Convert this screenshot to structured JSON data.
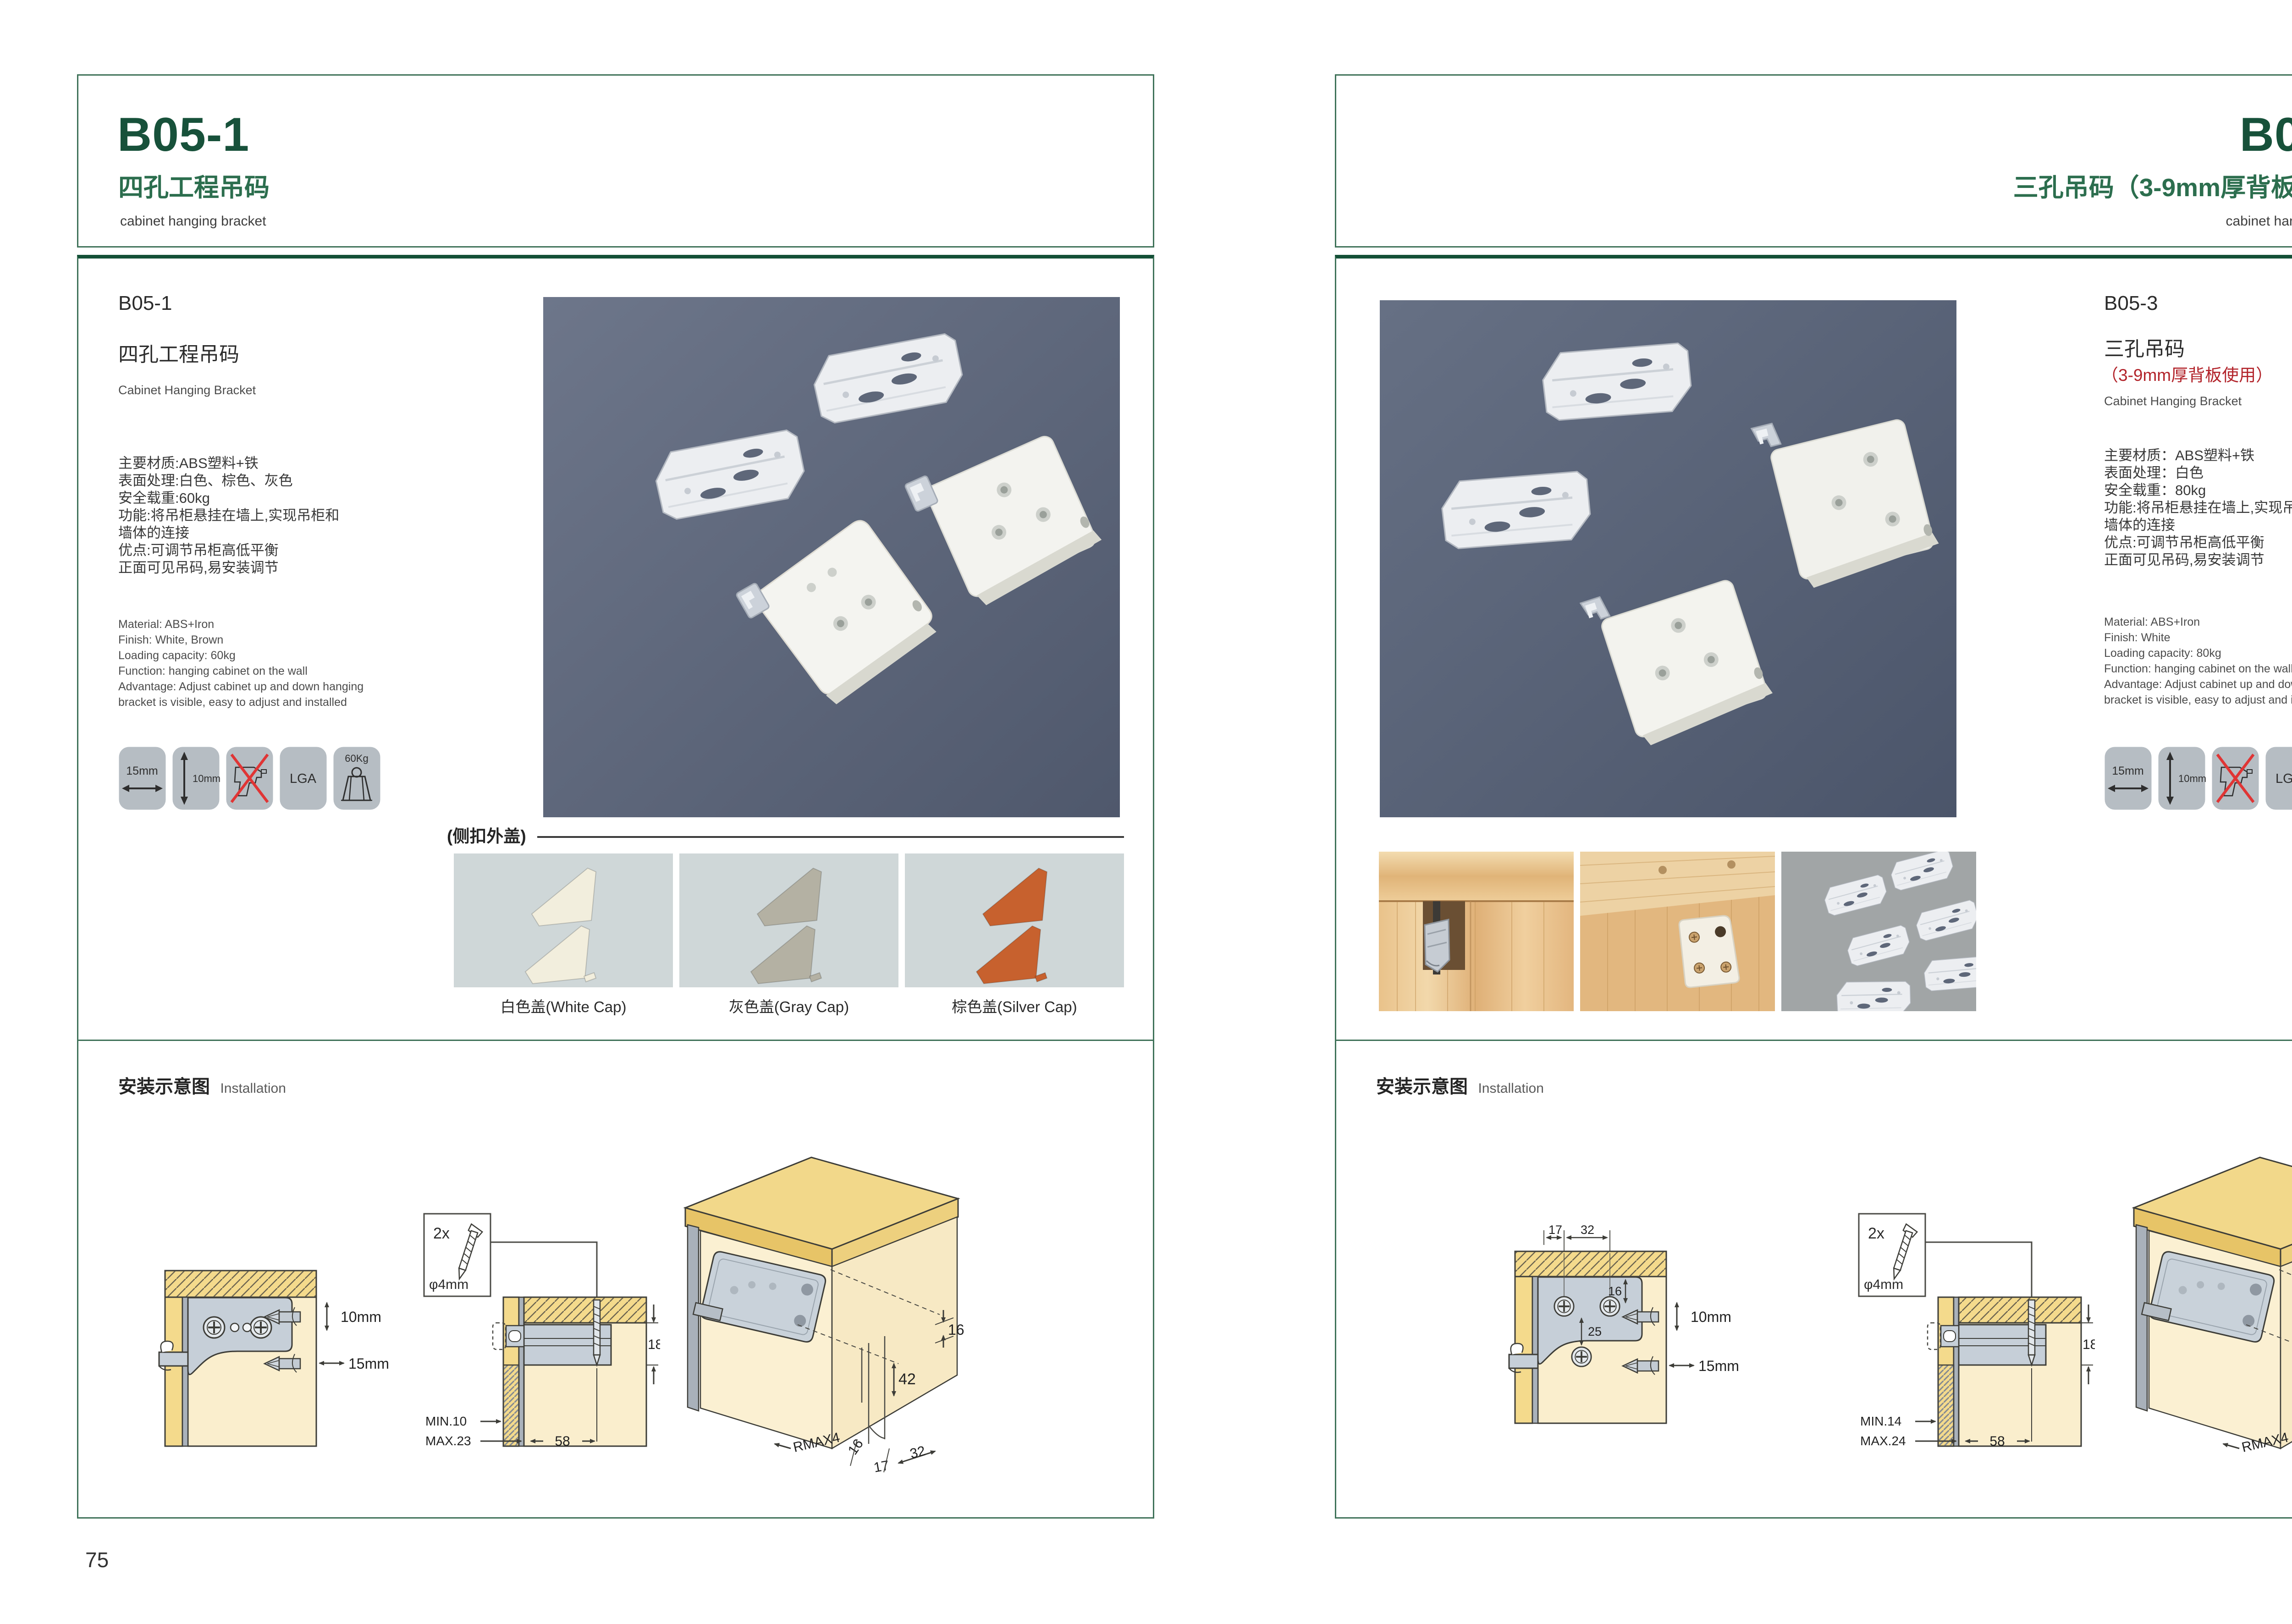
{
  "colors": {
    "brand_green": "#17513a",
    "mid_green": "#2c6e4e",
    "border_green": "#3f7259",
    "red": "#b2232a",
    "photo_bg_left": "#5a6477",
    "photo_bg_right": "#525c6f",
    "icon_bg": "#b6bdc3"
  },
  "left_page": {
    "header": {
      "code": "B05-1",
      "title_zh": "四孔工程吊码",
      "title_en": "cabinet hanging bracket"
    },
    "product": {
      "code": "B05-1",
      "name_zh": "四孔工程吊码",
      "name_en": "Cabinet Hanging Bracket",
      "specs_zh": [
        "主要材质:ABS塑料+铁",
        "表面处理:白色、棕色、灰色",
        "安全载重:60kg",
        "功能:将吊柜悬挂在墙上,实现吊柜和",
        "墙体的连接",
        "优点:可调节吊柜高低平衡",
        "正面可见吊码,易安装调节"
      ],
      "specs_en": [
        "Material: ABS+Iron",
        "Finish: White, Brown",
        "Loading capacity: 60kg",
        "Function: hanging cabinet on the wall",
        "Advantage: Adjust cabinet up and down hanging",
        "bracket is visible, easy to adjust and installed"
      ],
      "icons": {
        "width": "15mm",
        "height": "10mm",
        "cert": "LGA",
        "load": "60Kg"
      }
    },
    "caps": {
      "label": "(侧扣外盖)",
      "items": [
        {
          "caption": "白色盖(White Cap)",
          "color": "#f2eedd"
        },
        {
          "caption": "灰色盖(Gray Cap)",
          "color": "#b4b1a3"
        },
        {
          "caption": "棕色盖(Silver Cap)",
          "color": "#c7612e"
        }
      ]
    },
    "installation": {
      "title_zh": "安装示意图",
      "title_en": "Installation",
      "a": {
        "bit_v": "10mm",
        "bit_h": "15mm"
      },
      "b": {
        "qty": "2x",
        "dia": "φ4mm",
        "depth": "18",
        "min": "MIN.10",
        "max": "MAX.23",
        "width": "58"
      },
      "c": {
        "inset": "16",
        "height": "42",
        "radius": "RMAX4",
        "d16": "16",
        "d17": "17",
        "d32": "32"
      }
    },
    "page_number": "75"
  },
  "right_page": {
    "header": {
      "code": "B05-3",
      "title_zh": "三孔吊码（3-9mm厚背板使用）",
      "title_en": "cabinet hanging bracket"
    },
    "product": {
      "code": "B05-3",
      "name_zh": "三孔吊码",
      "note": "（3-9mm厚背板使用）",
      "name_en": "Cabinet Hanging Bracket",
      "specs_zh": [
        "主要材质：ABS塑料+铁",
        "表面处理：白色",
        "安全载重：80kg",
        "功能:将吊柜悬挂在墙上,实现吊柜和",
        "墙体的连接",
        "优点:可调节吊柜高低平衡",
        "正面可见吊码,易安装调节"
      ],
      "specs_en": [
        "Material: ABS+Iron",
        "Finish: White",
        "Loading capacity: 80kg",
        "Function: hanging cabinet on the wall",
        "Advantage: Adjust cabinet up and down hanging",
        "bracket is visible, easy to adjust and installed"
      ],
      "icons": {
        "width": "15mm",
        "height": "10mm",
        "cert": "LGA",
        "load": "80Kg"
      }
    },
    "installation": {
      "title_zh": "安装示意图",
      "title_en": "Installation",
      "a": {
        "top1": "17",
        "top2": "32",
        "h1": "16",
        "h2": "25",
        "bit_v": "10mm",
        "bit_h": "15mm"
      },
      "b": {
        "qty": "2x",
        "dia": "φ4mm",
        "depth": "18",
        "min": "MIN.14",
        "max": "MAX.24",
        "width": "58"
      },
      "c": {
        "inset": "16",
        "height": "42",
        "radius": "RMAX4",
        "d18": "18",
        "d17": "17",
        "d32": "32"
      }
    },
    "page_number": "76"
  }
}
